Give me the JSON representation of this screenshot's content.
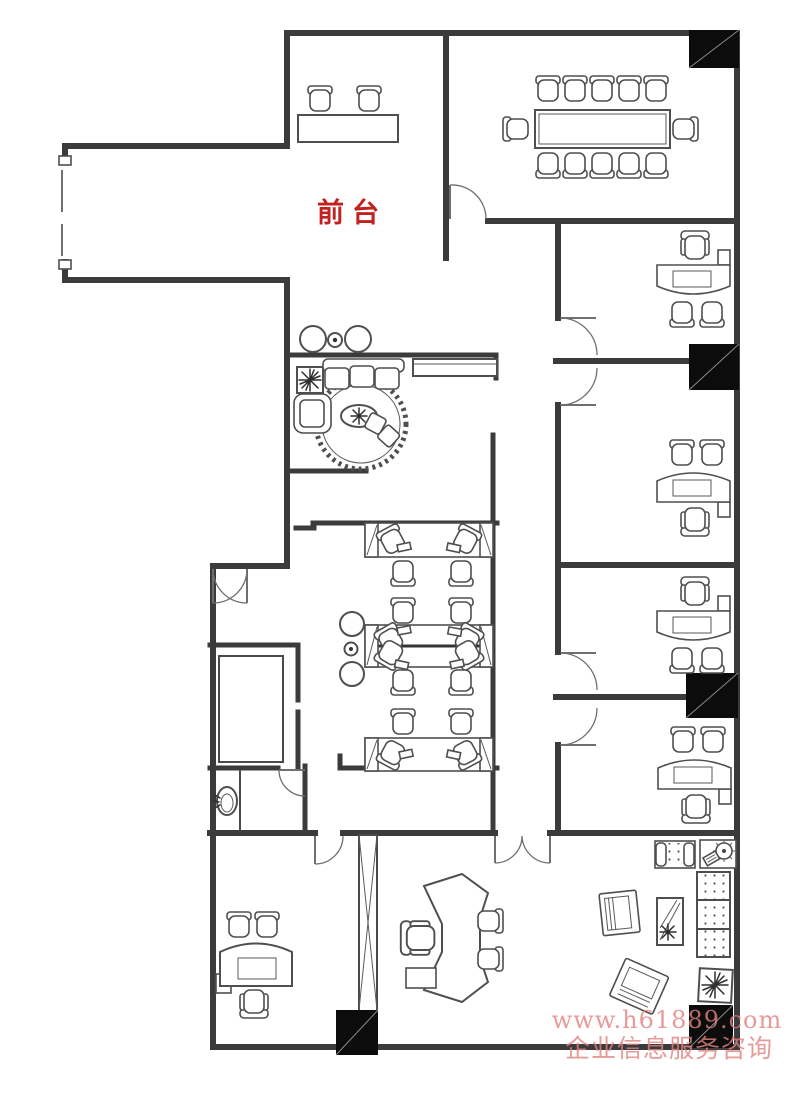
{
  "labels": {
    "reception": "前台"
  },
  "watermark": {
    "line1": "www.h61889.com",
    "line2": "企业信息服务咨询"
  },
  "colors": {
    "background": "#ffffff",
    "wall": "#3b3b3b",
    "furniture_line": "#4f4f4f",
    "column_fill": "#0c0c0c",
    "reception_label": "#c2221f",
    "watermark": "#e2827f"
  }
}
